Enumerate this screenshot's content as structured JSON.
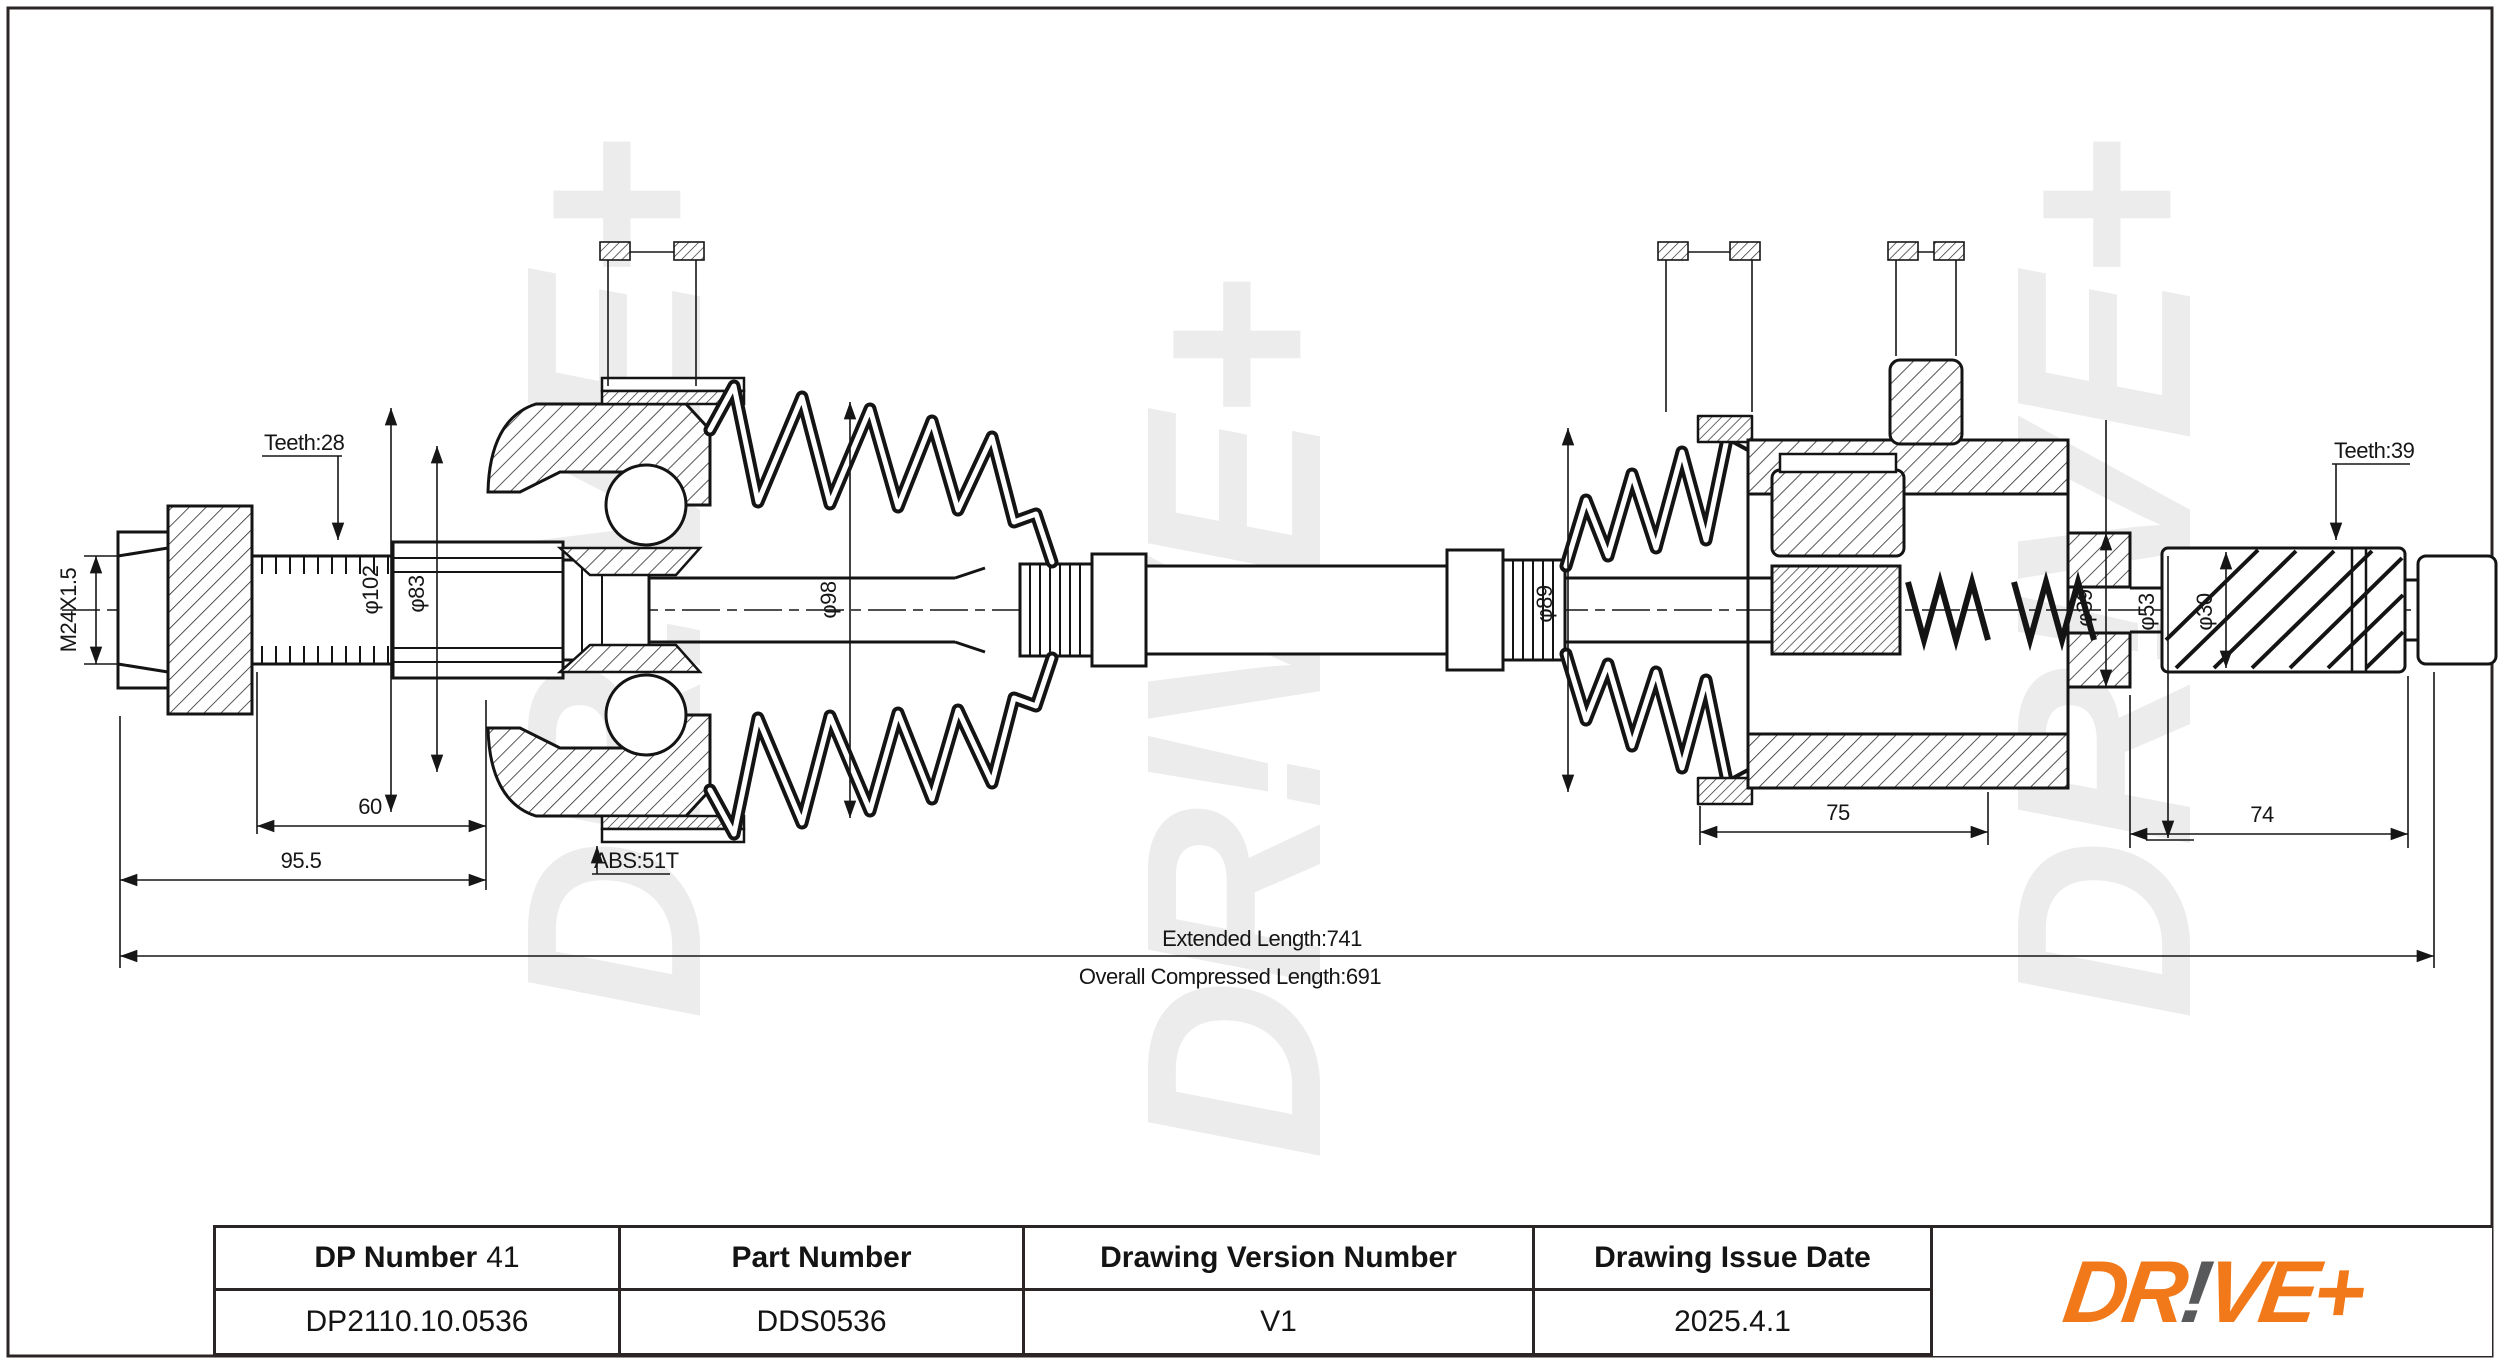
{
  "dims": {
    "teeth_left": "Teeth:28",
    "thread": "M24X1.5",
    "dia102": "φ102",
    "dia83": "φ83",
    "dia98": "φ98",
    "abs": "ABS:51T",
    "dia89": "φ89",
    "teeth_right": "Teeth:39",
    "dia39": "φ39",
    "dia53": "φ53",
    "dia30": "φ30",
    "len60": "60",
    "len95": "95.5",
    "len75": "75",
    "len74": "74",
    "extended": "Extended Length:741",
    "compressed": "Overall Compressed Length:691"
  },
  "watermark": {
    "text": "DR!VE+",
    "color": "#ececec"
  },
  "table": {
    "header_dp_label": "DP Number",
    "header_dp_number": "41",
    "header_part": "Part Number",
    "header_version": "Drawing Version Number",
    "header_date": "Drawing Issue Date",
    "value_dp": "DP2110.10.0536",
    "value_part": "DDS0536",
    "value_version": "V1",
    "value_date": "2025.4.1"
  },
  "logo": {
    "dr": "DR",
    "bang": "!",
    "vep": "VE+",
    "orange": "#F2791A",
    "gray": "#58595B"
  }
}
